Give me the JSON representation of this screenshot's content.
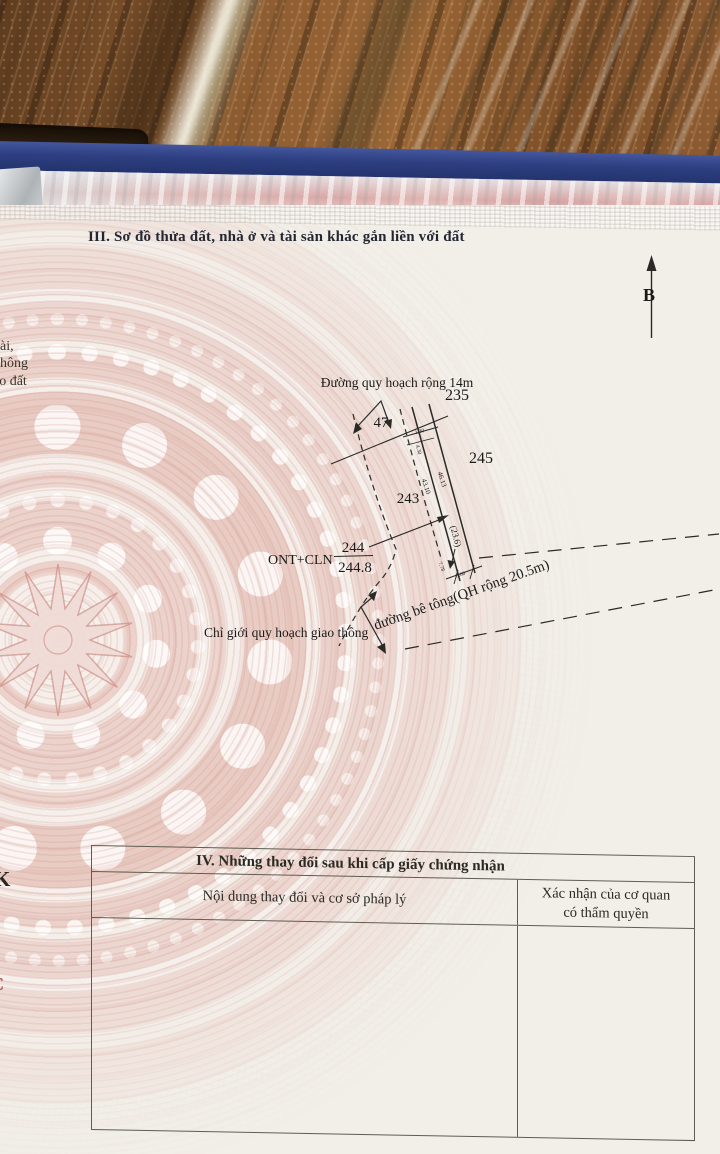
{
  "colors": {
    "paper": "#f2efe8",
    "pattern-pink": "#e9cdc6",
    "book-blue": "#2d3f80",
    "wood-brown": "#8a5a30",
    "ink": "#1d1c1a",
    "table-line": "#5f5d52",
    "red-letter": "#9c3a32"
  },
  "section3": {
    "heading": "III. Sơ đồ thửa đất, nhà ở và tài sản khác gắn liền với đất"
  },
  "edge_text": {
    "line1": "dài,",
    "line2": "không",
    "line3": "ao đất",
    "letter_k": "K",
    "letter_c": "C"
  },
  "diagram": {
    "north_label": "B",
    "planned_road_label": "Đường quy hoạch rộng 14m",
    "concrete_road_label": "đường bê tông(QH rộng 20.5m)",
    "boundary_label": "Chỉ giới quy hoạch giao thông",
    "land_use_code": "ONT+CLN",
    "parcel_number": "244",
    "parcel_area": "244.8",
    "neighbor_parcels": {
      "p235": "235",
      "p47": "47",
      "p245": "245",
      "p243": "243"
    },
    "dimensions": {
      "left_edge": "43.10",
      "right_edge": "46.13",
      "inner": "(23.6)",
      "top_a": "1.30",
      "top_b": "4.30",
      "bottom_a": "7.78",
      "bottom_b": "5.00"
    }
  },
  "section4": {
    "title": "IV. Những thay đổi sau khi cấp giấy chứng nhận",
    "col1_header": "Nội dung thay đổi và cơ sở pháp lý",
    "col2_header_line1": "Xác nhận của cơ quan",
    "col2_header_line2": "có thẩm quyền"
  }
}
